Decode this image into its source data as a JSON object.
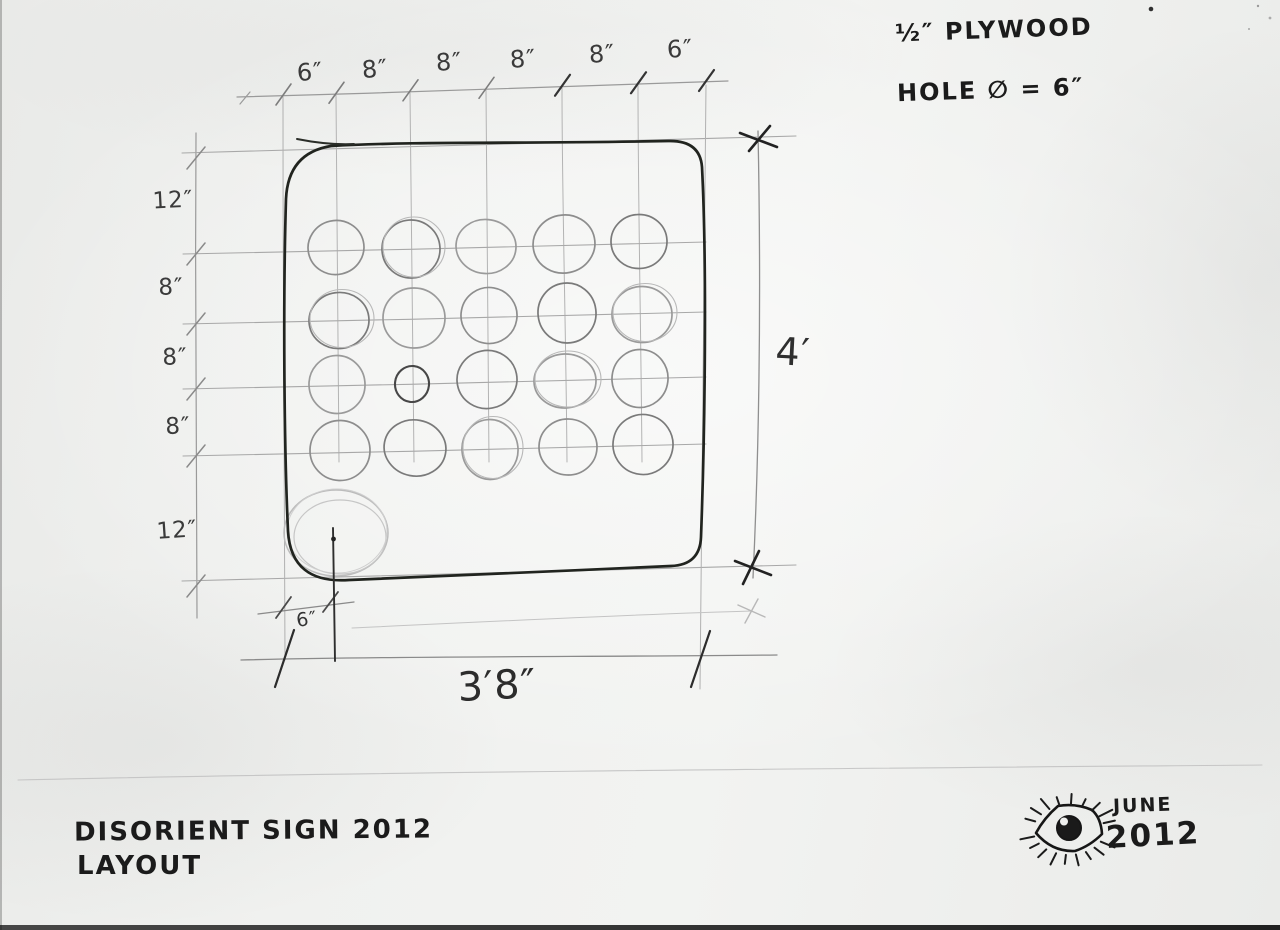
{
  "notes": {
    "material": "½″ PLYWOOD",
    "hole_diameter": "HOLE ∅ = 6″"
  },
  "dimensions": {
    "top_spacings": [
      "6″",
      "8″",
      "8″",
      "8″",
      "8″",
      "6″"
    ],
    "left_spacings": [
      "12″",
      "8″",
      "8″",
      "8″",
      "12″"
    ],
    "right_height": "4′",
    "bottom_hole_offset": "6″",
    "bottom_width": "3′8″"
  },
  "panel": {
    "holes": {
      "rows": 4,
      "cols": 5,
      "cols_x": [
        338,
        413,
        488,
        566,
        641
      ],
      "rows_y": [
        249,
        319,
        384,
        451
      ],
      "default_radius_px": 28,
      "small_dark_hole": {
        "row": 2,
        "col": 1,
        "radius_px": 18
      },
      "ghost_hole": {
        "cx": 336,
        "cy": 533,
        "rx": 52,
        "ry": 43
      }
    }
  },
  "title_block": {
    "line1": "DISORIENT SIGN 2012",
    "line2": "LAYOUT"
  },
  "date_block": {
    "month": "JUNE",
    "year": "2012"
  },
  "colors": {
    "paper": "#eeefed",
    "ink": "#1b1b1b",
    "pencil_light": "#9a9a9a",
    "pencil_dark": "#3a3a3a"
  }
}
